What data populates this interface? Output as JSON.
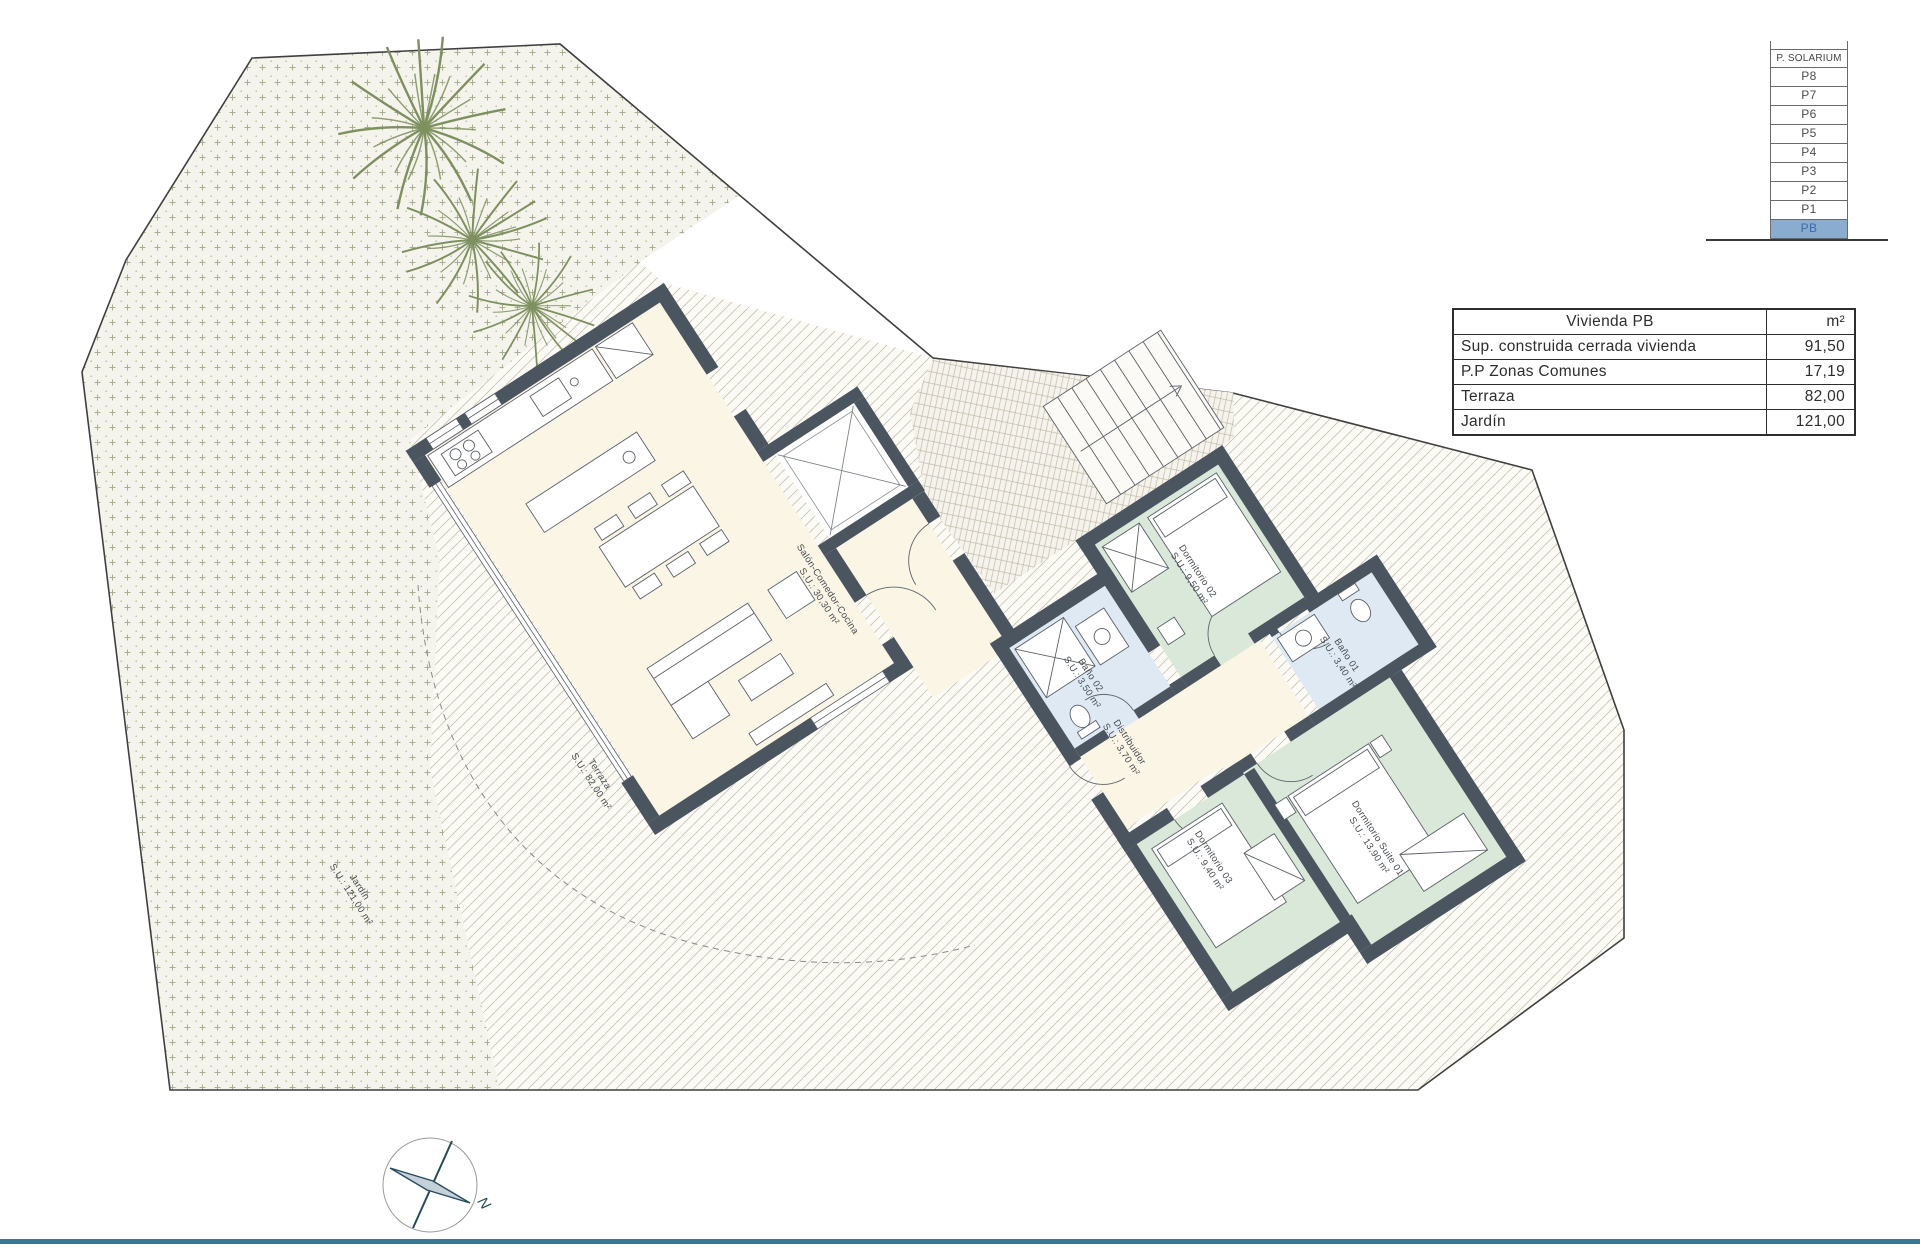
{
  "floor_selector": {
    "header": "P. SOLARIUM",
    "floors": [
      "P8",
      "P7",
      "P6",
      "P5",
      "P4",
      "P3",
      "P2",
      "P1",
      "PB"
    ],
    "active_floor": "PB",
    "active_bg": "#8aadcf",
    "active_text": "#3c6ca5"
  },
  "area_table": {
    "title": "Vivienda PB",
    "unit_header": "m²",
    "rows": [
      {
        "label": "Sup. construida cerrada vivienda",
        "value": "91,50"
      },
      {
        "label": "P.P Zonas Comunes",
        "value": "17,19"
      },
      {
        "label": "Terraza",
        "value": "82,00"
      },
      {
        "label": "Jardín",
        "value": "121,00"
      }
    ]
  },
  "plan": {
    "rooms": [
      {
        "id": "salon",
        "name": "Salón-Comedor-Cocina",
        "area": "S.U.: 30,30 m²"
      },
      {
        "id": "dormitorio02",
        "name": "Dormitorio 02",
        "area": "S.U.: 9,50 m²"
      },
      {
        "id": "bano02",
        "name": "Baño 02",
        "area": "S.U.: 3,50 m²"
      },
      {
        "id": "bano01",
        "name": "Baño 01",
        "area": "S.U.: 3,40 m²"
      },
      {
        "id": "distribuidor",
        "name": "Distribuidor",
        "area": "S.U.: 3,70 m²"
      },
      {
        "id": "dormitorio03",
        "name": "Dormitorio 03",
        "area": "S.U.: 9,40 m²"
      },
      {
        "id": "suite01",
        "name": "Dormitorio Suite 01",
        "area": "S.U.: 13,90 m²"
      },
      {
        "id": "terraza",
        "name": "Terraza",
        "area": "S.U.: 82,00 m²"
      },
      {
        "id": "jardin",
        "name": "Jardín",
        "area": "S.U.: 121,00 m²"
      }
    ],
    "compass_label": "N"
  },
  "colors": {
    "wall": "#4b5560",
    "living_floor": "#faf5e5",
    "bedroom_floor": "#d9e8d9",
    "bathroom_floor": "#dfe9f3",
    "garden_mark": "#a9ae90",
    "tree": "#7e905f",
    "bottom_bar": "#3e7795",
    "compass": "#274b5e"
  }
}
